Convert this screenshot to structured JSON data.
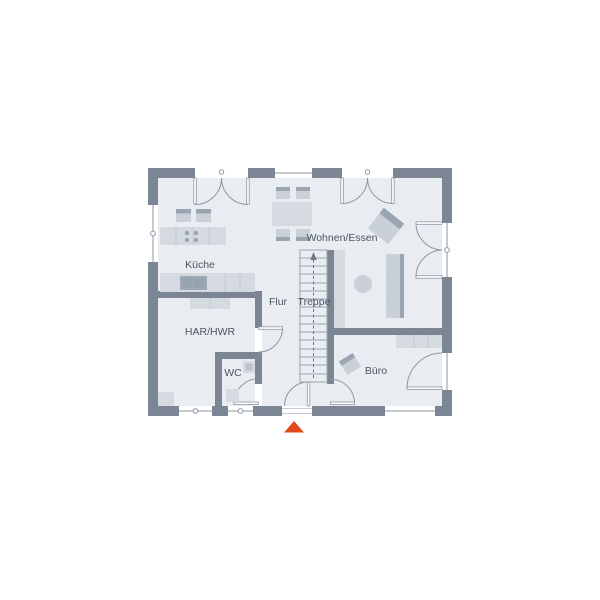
{
  "floor_plan": {
    "rooms": [
      {
        "name": "Küche"
      },
      {
        "name": "Wohnen/Essen"
      },
      {
        "name": "Flur"
      },
      {
        "name": "Treppe"
      },
      {
        "name": "HAR/HWR"
      },
      {
        "name": "WC"
      },
      {
        "name": "Büro"
      }
    ],
    "colors": {
      "background": "#ffffff",
      "wall": "#7b8594",
      "floor": "#e9edf2",
      "furniture_light": "#d5dae1",
      "furniture_mid": "#c9d0d8",
      "furniture_dark": "#9aa5b2",
      "fixture_dark": "#a0aab7",
      "line": "#8d97a4",
      "label": "#4a5560",
      "entrance_marker": "#e2491b"
    }
  }
}
